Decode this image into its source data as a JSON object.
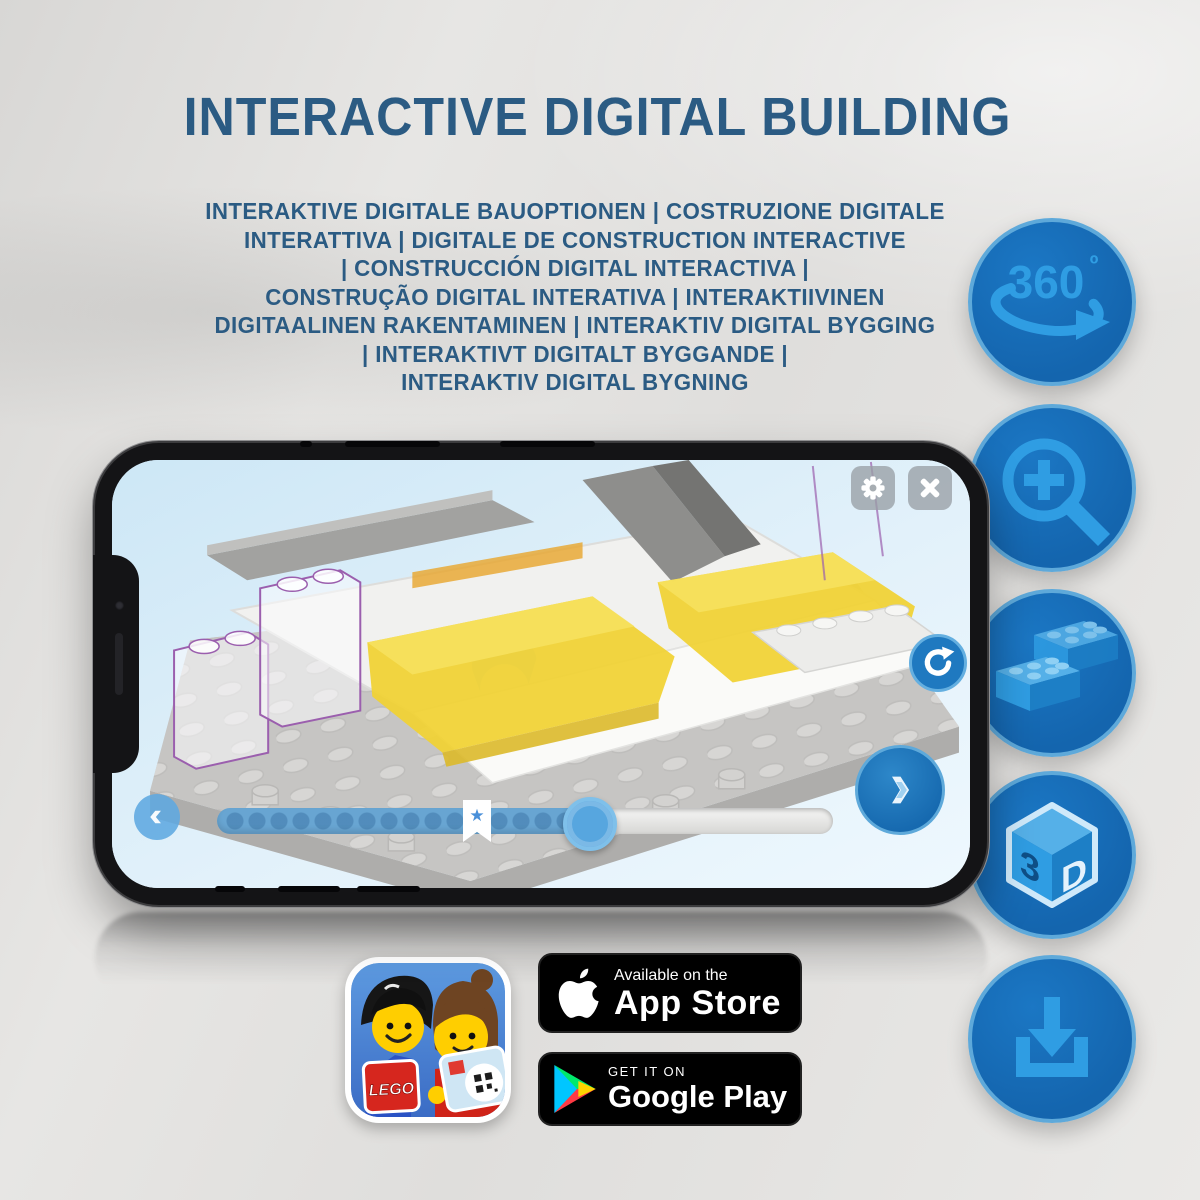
{
  "header": {
    "title": "INTERACTIVE DIGITAL BUILDING"
  },
  "subtitle": {
    "lines": [
      "INTERAKTIVE DIGITALE BAUOPTIONEN | COSTRUZIONE DIGITALE",
      "INTERATTIVA | DIGITALE DE CONSTRUCTION INTERACTIVE",
      "| CONSTRUCCIÓN DIGITAL INTERACTIVA |",
      "CONSTRUÇÃO DIGITAL INTERATIVA | INTERAKTIIVINEN",
      "DIGITAALINEN RAKENTAMINEN | INTERAKTIV DIGITAL BYGGING",
      "| INTERAKTIVT DIGITALT BYGGANDE |",
      "INTERAKTIV DIGITAL BYGNING"
    ]
  },
  "features": [
    {
      "name": "360-rotation-icon",
      "label": "360",
      "degree": "º"
    },
    {
      "name": "zoom-in-icon"
    },
    {
      "name": "lego-bricks-icon"
    },
    {
      "name": "3d-cube-icon",
      "face_left": "3",
      "face_right": "D"
    },
    {
      "name": "download-icon"
    }
  ],
  "phone_ui": {
    "bookmark_star": "★",
    "icons": [
      "gear-icon",
      "close-icon",
      "rotate-cw-icon",
      "chevron-left-icon",
      "chevron-right-icon"
    ]
  },
  "store": {
    "app_store": {
      "tagline": "Available on the",
      "name": "App Store"
    },
    "google_play": {
      "tagline": "GET IT ON",
      "name": "Google Play"
    }
  },
  "app_icon": {
    "brand": "LEGO"
  },
  "colors": {
    "heading_blue": "#2b5b83",
    "circle_fill": "#1568b2",
    "circle_rim": "#5ea9da",
    "icon_blue": "#2f9de3",
    "screen_sky": "#d9edf9",
    "brick_yellow": "#f1d233",
    "ghost_outline_purple": "#9b5fae",
    "play_cyan": "#00c6ff",
    "play_green": "#00e96c",
    "play_yellow": "#ffd500",
    "play_red": "#ff3a44"
  }
}
